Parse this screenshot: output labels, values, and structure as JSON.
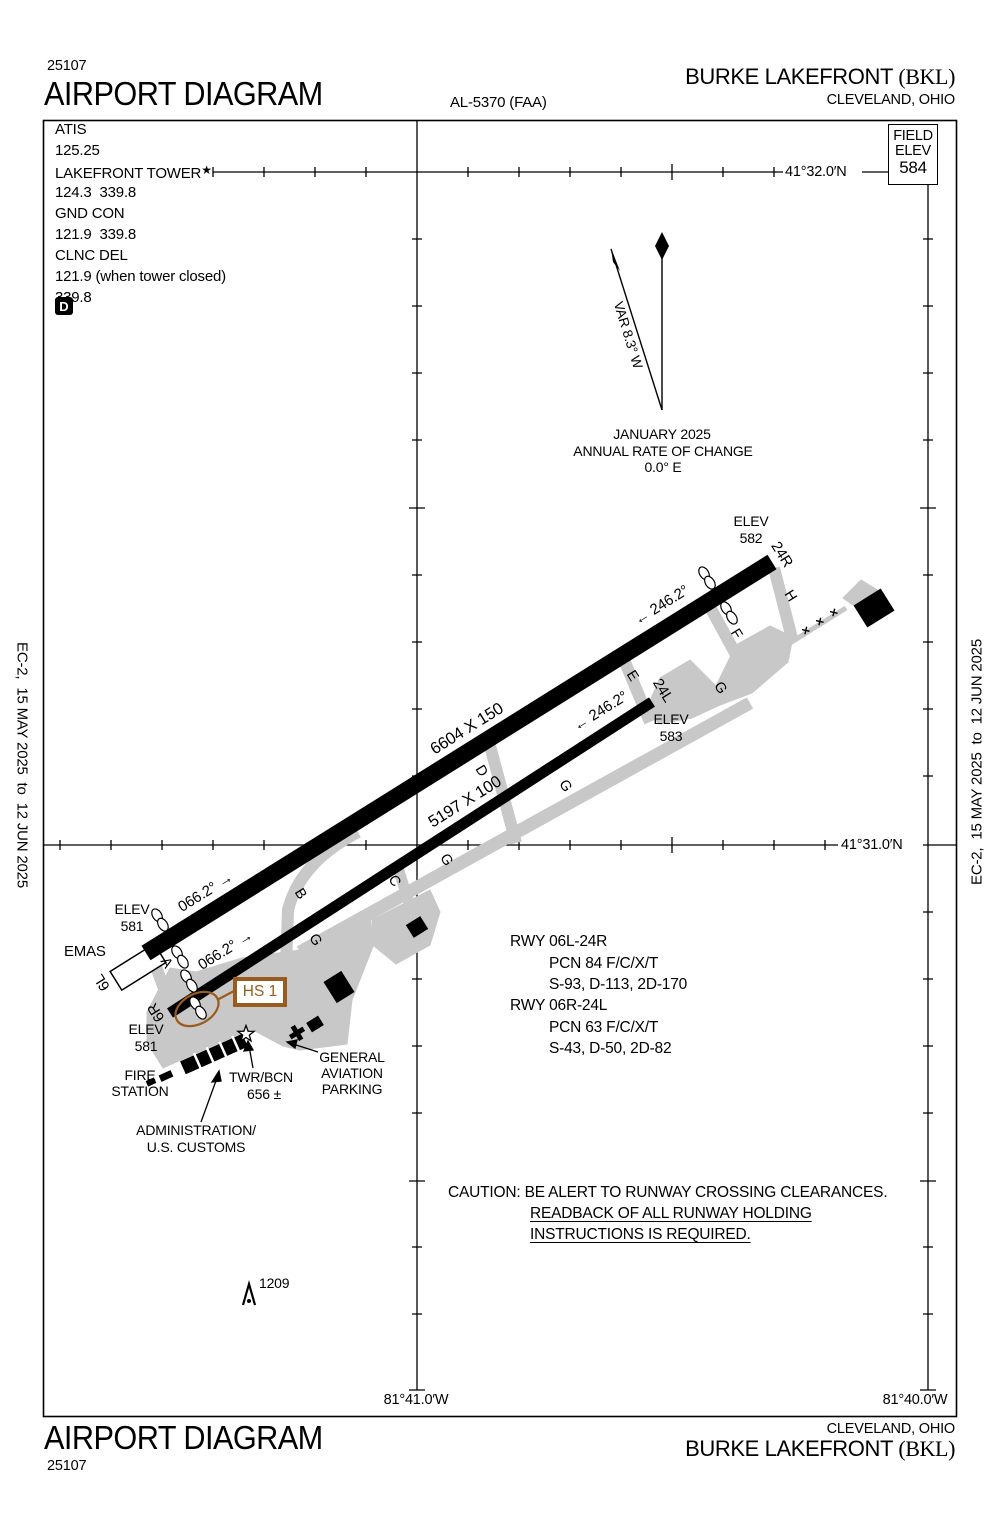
{
  "header": {
    "code": "25107",
    "title": "AIRPORT DIAGRAM",
    "al_number": "AL-5370 (FAA)",
    "airport": "BURKE LAKEFRONT ",
    "icao": "(BKL)",
    "city": "CLEVELAND, OHIO"
  },
  "footer": {
    "title": "AIRPORT DIAGRAM",
    "code": "25107",
    "airport": "BURKE LAKEFRONT ",
    "icao": "(BKL)",
    "city": "CLEVELAND, OHIO"
  },
  "edition": {
    "side_text": "EC-2,  15 MAY 2025  to  12 JUN 2025"
  },
  "comm": {
    "lines": [
      "ATIS",
      "125.25",
      "LAKEFRONT TOWER",
      "124.3  339.8",
      "GND CON",
      "121.9  339.8",
      "CLNC DEL",
      "121.9 (when tower closed)",
      "339.8"
    ],
    "tower_star": "★",
    "d_symbol": "D"
  },
  "field_elev": {
    "label1": "FIELD",
    "label2": "ELEV",
    "value": "584"
  },
  "graticule": {
    "lat_north": "41°32.0′N",
    "lat_south": "41°31.0′N",
    "lon_west": "81°41.0′W",
    "lon_east": "81°40.0′W"
  },
  "compass": {
    "variation": "VAR 8.3° W",
    "date": "JANUARY 2025",
    "rate_label": "ANNUAL RATE OF CHANGE",
    "rate_value": "0.0° E"
  },
  "runways": {
    "rwy_06l_24r": {
      "dim": "6604 X 150",
      "hdg_ne": "066.2° →",
      "hdg_sw": "← 246.2°",
      "end_ne": "24R",
      "end_sw": "6L",
      "elev_ne": "582",
      "elev_sw": "581"
    },
    "rwy_06r_24l": {
      "dim": "5197 X 100",
      "hdg_ne": "066.2° →",
      "hdg_sw": "← 246.2°",
      "end_ne": "24L",
      "end_sw": "6R",
      "elev_ne": "583",
      "elev_sw": "581"
    },
    "elev_word": "ELEV",
    "emas": "EMAS"
  },
  "taxiways": {
    "a": "A",
    "b": "B",
    "c": "C",
    "d": "D",
    "e": "E",
    "f": "F",
    "g": "G",
    "h": "H",
    "closed_mark": "×"
  },
  "hotspot": {
    "label": "HS 1"
  },
  "obstacle": {
    "elevation": "1209"
  },
  "data_block": {
    "lines": [
      "RWY 06L-24R",
      "PCN 84 F/C/X/T",
      "S-93, D-113, 2D-170",
      "RWY 06R-24L",
      "PCN 63 F/C/X/T",
      "S-43, D-50, 2D-82"
    ]
  },
  "caution": {
    "line1": "CAUTION: BE ALERT TO RUNWAY CROSSING CLEARANCES.",
    "line2": "READBACK OF ALL RUNWAY HOLDING",
    "line3": "INSTRUCTIONS IS REQUIRED."
  },
  "annotations": {
    "fire_line1": "FIRE",
    "fire_line2": "STATION",
    "twr_line1": "TWR/BCN",
    "twr_line2": "656 ±",
    "ga_line1": "GENERAL",
    "ga_line2": "AVIATION",
    "ga_line3": "PARKING",
    "admin_line1": "ADMINISTRATION/",
    "admin_line2": "U.S. CUSTOMS"
  },
  "colors": {
    "taxiway_gray": "#c8c8c8",
    "hotspot_brown": "#9a5c1e",
    "ink": "#000000"
  }
}
